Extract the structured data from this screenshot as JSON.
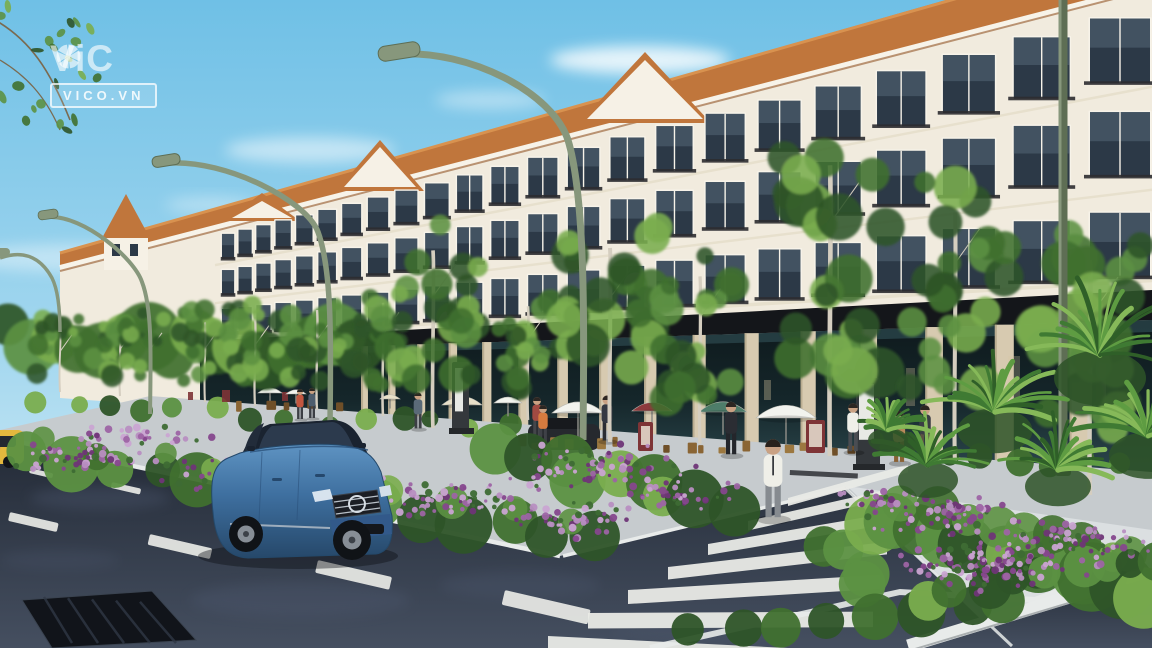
{
  "watermark": {
    "brand": "ViCO",
    "brand_display_prefix": "ViC",
    "icon": "aperture-icon",
    "domain_badge": "VICO.VN"
  },
  "palette": {
    "sky_top": "#6fc0e6",
    "sky_mid": "#a5d8ef",
    "sky_horizon": "#e3f2f9",
    "cloud": "#ffffff",
    "roof": "#c0763c",
    "roof_light": "#d8924f",
    "roof_shadow": "#925526",
    "facade": "#f1ebde",
    "facade_shade": "#d9cfba",
    "pediment": "#f6f1e6",
    "molding": "#e7dfcc",
    "frame": "#f7f3e9",
    "window_glass": "#2c3947",
    "window_glass_light": "#5e7080",
    "fascia": "#14161a",
    "storefront_dark": "#0e191c",
    "storefront": "#15262a",
    "storefront_light": "#2e4a50",
    "pilaster": "#d7cab0",
    "glint": "#d9c9a0",
    "road_far": "#232a36",
    "road_near": "#454f60",
    "road_patch": "#55617a",
    "lane_white": "#e9eae6",
    "sidewalk": "#c6cbce",
    "sidewalk_light": "#dde1e3",
    "curb": "#e8ebea",
    "hedge_dark": "#2e5428",
    "hedge_mid": "#40702f",
    "hedge_light": "#5c9142",
    "leaf_light": "#7aad4e",
    "trunk": "#d5cec0",
    "flower_a": "#9d64a4",
    "flower_b": "#86478d",
    "flower_c": "#b88ec1",
    "flower_d": "#6f3577",
    "flower_e": "#caa4d2",
    "lamp": "#87977c",
    "lamp_dark": "#5e6e54",
    "car_blue": "#3e6f9f",
    "car_blue_light": "#5e93c2",
    "car_blue_dark": "#26486a",
    "car_glass": "#2c3a4d",
    "car_dark": "#1a2330",
    "taxi": "#e4b83e",
    "parked": "#26292e",
    "umbrella_white": "#f2f3ee",
    "umbrella_red": "#8e3a3d",
    "umbrella_teal": "#4e7d6a",
    "umbrella_cream": "#e8e0c8",
    "kiosk": "#34383c",
    "screen": "#f2f2ee",
    "sign_maroon": "#7e3436",
    "chair": "#8a6534",
    "chair_dark": "#6f4f28",
    "skin": "#c9a183",
    "hair": "#2c2622",
    "shirt_white": "#efefe8",
    "trouser": "#868b90",
    "suit": "#2b2d33",
    "drain": "#11141a",
    "drain_rib": "#303845"
  }
}
